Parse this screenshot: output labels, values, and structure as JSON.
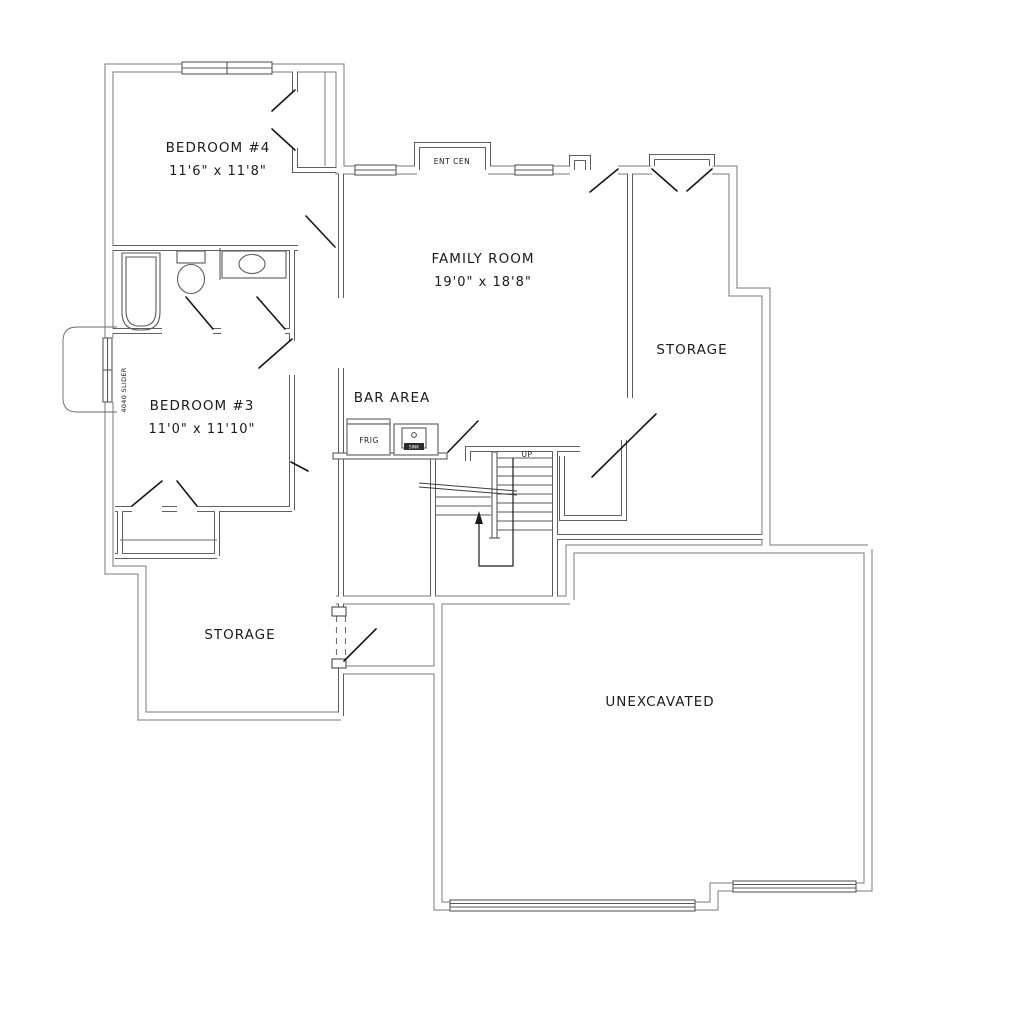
{
  "colors": {
    "background": "#ffffff",
    "wall_exterior": "#7a7a7a",
    "wall_interior": "#4a4a4a",
    "fixture_line": "#5a5a5a",
    "door_line": "#171717",
    "text": "#1b1b1b"
  },
  "rooms": {
    "bedroom4": {
      "label": "BEDROOM #4",
      "dims": "11'6\" x 11'8\""
    },
    "family_room": {
      "label": "FAMILY ROOM",
      "dims": "19'0\" x 18'8\""
    },
    "storage_right": {
      "label": "STORAGE"
    },
    "bedroom3": {
      "label": "BEDROOM #3",
      "dims": "11'0\" x 11'10\""
    },
    "bar_area": {
      "label": "BAR AREA"
    },
    "storage_lower": {
      "label": "STORAGE"
    },
    "unexcavated": {
      "label": "UNEXCAVATED"
    }
  },
  "annotations": {
    "entertainment_center": "ENT CEN",
    "slider_window": "4040 SLIDER",
    "stairs_up": "UP",
    "fridge": "FRIG",
    "bar_sink": "SINK"
  }
}
